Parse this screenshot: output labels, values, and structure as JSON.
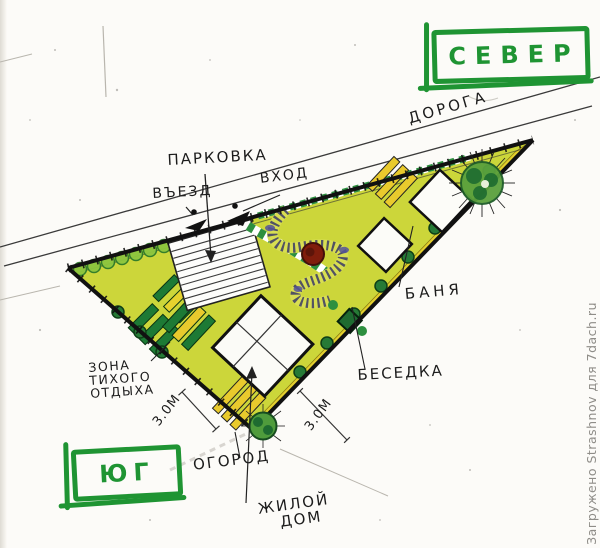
{
  "compass": {
    "north": "СЕВЕР",
    "south": "ЮГ"
  },
  "labels": {
    "road": "ДОРОГА",
    "parking": "ПАРКОВКА",
    "entrance": "ВХОД",
    "drive_in": "ВЪЕЗД",
    "bathhouse": "БАНЯ",
    "gazebo": "БЕСЕДКА",
    "quiet_zone_line1": "ЗОНА",
    "quiet_zone_line2": "ТИХОГО",
    "quiet_zone_line3": "ОТДЫХА",
    "garden": "ОГОРОД",
    "house_line1": "ЖИЛОЙ",
    "house_line2": "ДОМ",
    "dim_left": "3.0М",
    "dim_right": "3.0М"
  },
  "watermark": "Загружено Strashnov для 7dach.ru",
  "colors": {
    "marker_green": "#1f9433",
    "plot_fill": "#ccd63a",
    "bed_yellow": "#e9ca2d",
    "hedge_dark_green": "#1d7a35",
    "bush_green": "#267a36",
    "accent_red": "#801d0c",
    "accent_purple": "#55549a",
    "ink": "#1c1c1c",
    "watermark_gray": "#8f8d88"
  }
}
